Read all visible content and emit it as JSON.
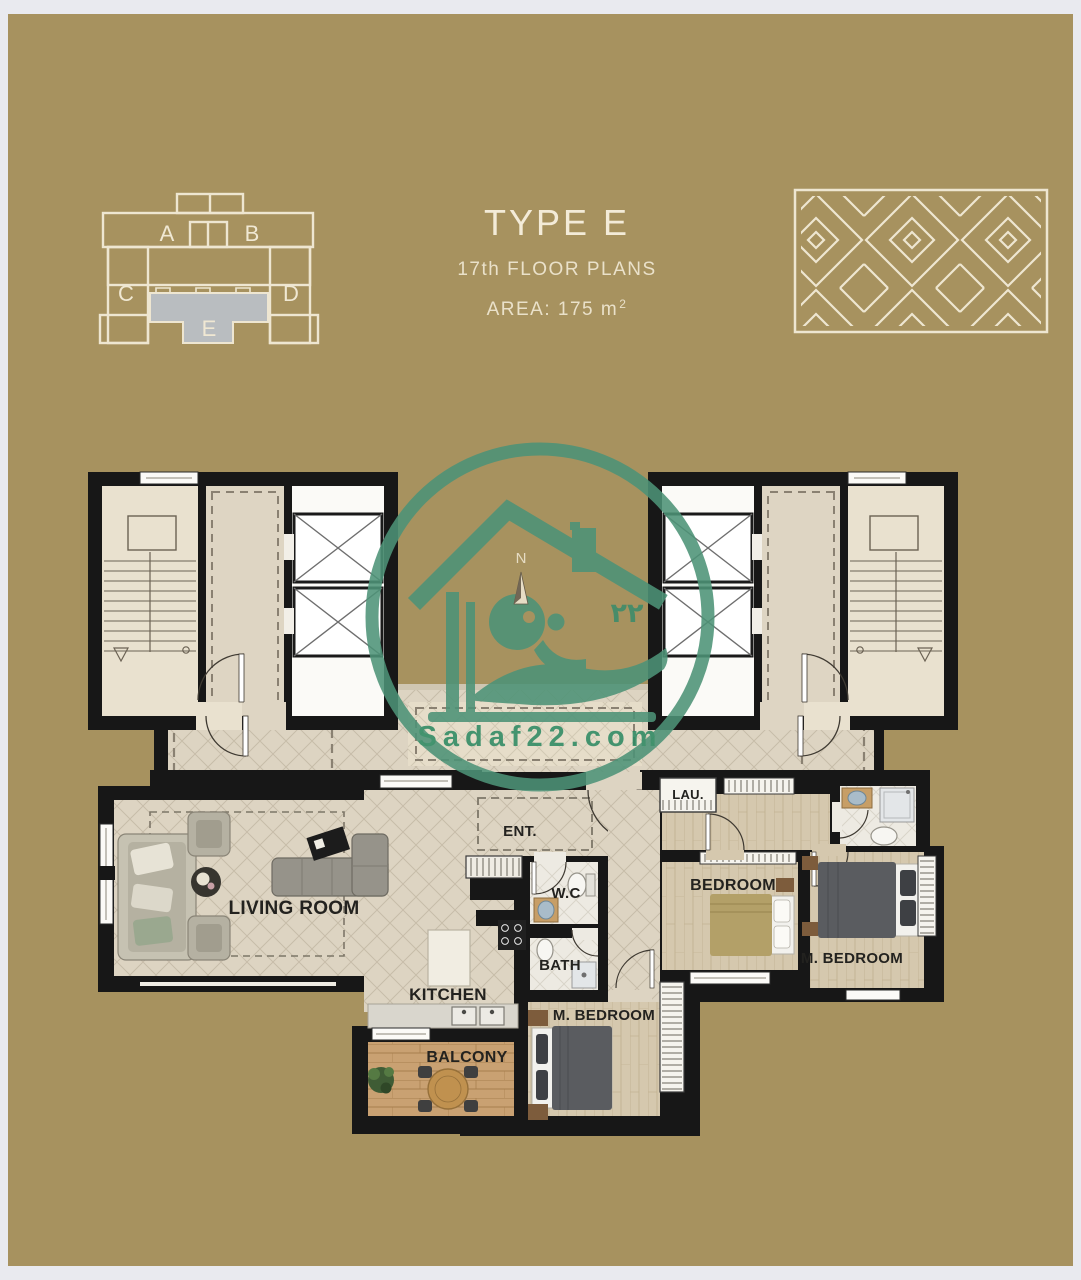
{
  "title_block": {
    "type_label": "TYPE E",
    "floor_label": "17th FLOOR PLANS",
    "area_label": "AREA: 175 m",
    "area_superscript": "2"
  },
  "key_plan": {
    "units": {
      "a": "A",
      "b": "B",
      "c": "C",
      "d": "D",
      "e": "E"
    },
    "highlighted_unit": "E"
  },
  "rooms": {
    "living_room": "LIVING ROOM",
    "kitchen": "KITCHEN",
    "balcony": "BALCONY",
    "entrance": "ENT.",
    "wc": "W.C",
    "bath": "BATH",
    "master_bedroom_lower": "M. BEDROOM",
    "master_bedroom_right": "M. BEDROOM",
    "bedroom": "BEDROOM",
    "laundry": "LAU."
  },
  "watermark": {
    "website": "Sadaf22.com",
    "arabic_number": "٢٢",
    "north_label": "N"
  },
  "colors": {
    "canvas_tan": "#a7925f",
    "line_cream": "#efe7d2",
    "wall_black": "#171717",
    "watermark_green": "#4d9377",
    "website_green": "#2e8a63",
    "highlight_gray": "#b9bdc0"
  }
}
